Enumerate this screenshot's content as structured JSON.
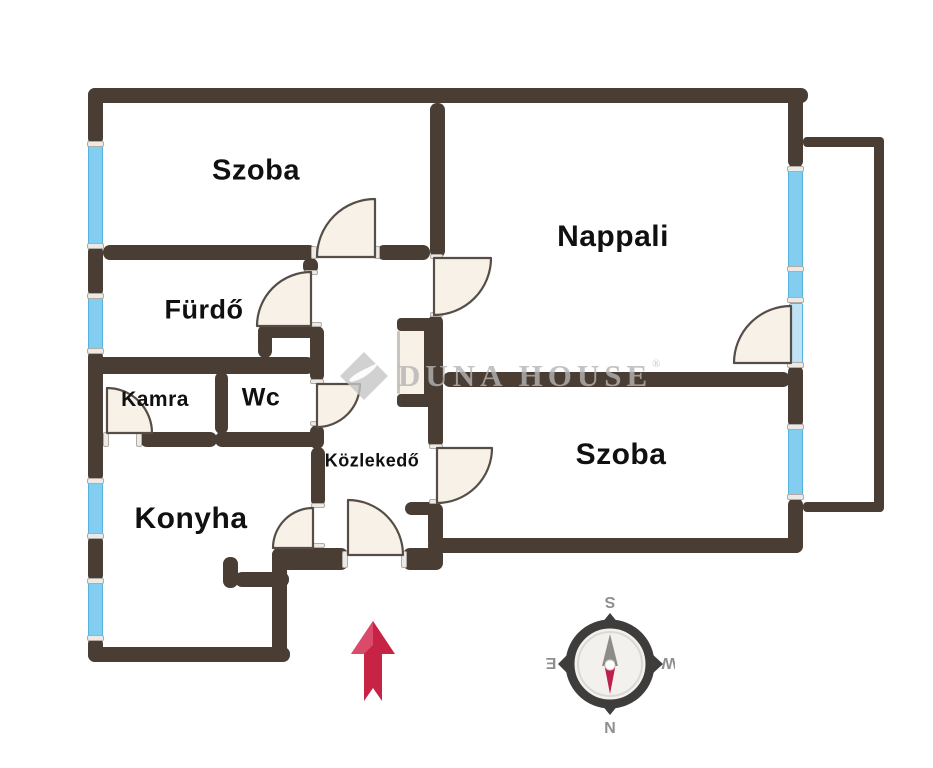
{
  "rooms": {
    "szoba_top": {
      "label": "Szoba"
    },
    "nappali": {
      "label": "Nappali"
    },
    "furdo": {
      "label": "Fürdő"
    },
    "kamra": {
      "label": "Kamra"
    },
    "wc": {
      "label": "Wc"
    },
    "kozlekedo": {
      "label": "Közlekedő"
    },
    "konyha": {
      "label": "Konyha"
    },
    "szoba_bottom": {
      "label": "Szoba"
    }
  },
  "watermark": {
    "text": "DUNA HOUSE",
    "registered": "®"
  },
  "compass": {
    "top": "S",
    "bottom": "N",
    "left": "E",
    "right": "W"
  },
  "icons": {
    "entrance_arrow": "up-arrow",
    "compass_rose": "compass-rose",
    "watermark_logo": "duna-house-diamond-logo"
  },
  "colors": {
    "wall": "#4a3e34",
    "window_blue": "#82cdf0",
    "door_cream": "#f8f1e8",
    "door_stroke": "#544e47",
    "arrow_red": "#c62345",
    "watermark_gray": "#b5b5b5",
    "compass_needle_red": "#bf1f4b",
    "compass_needle_gray": "#8e8c8a"
  }
}
